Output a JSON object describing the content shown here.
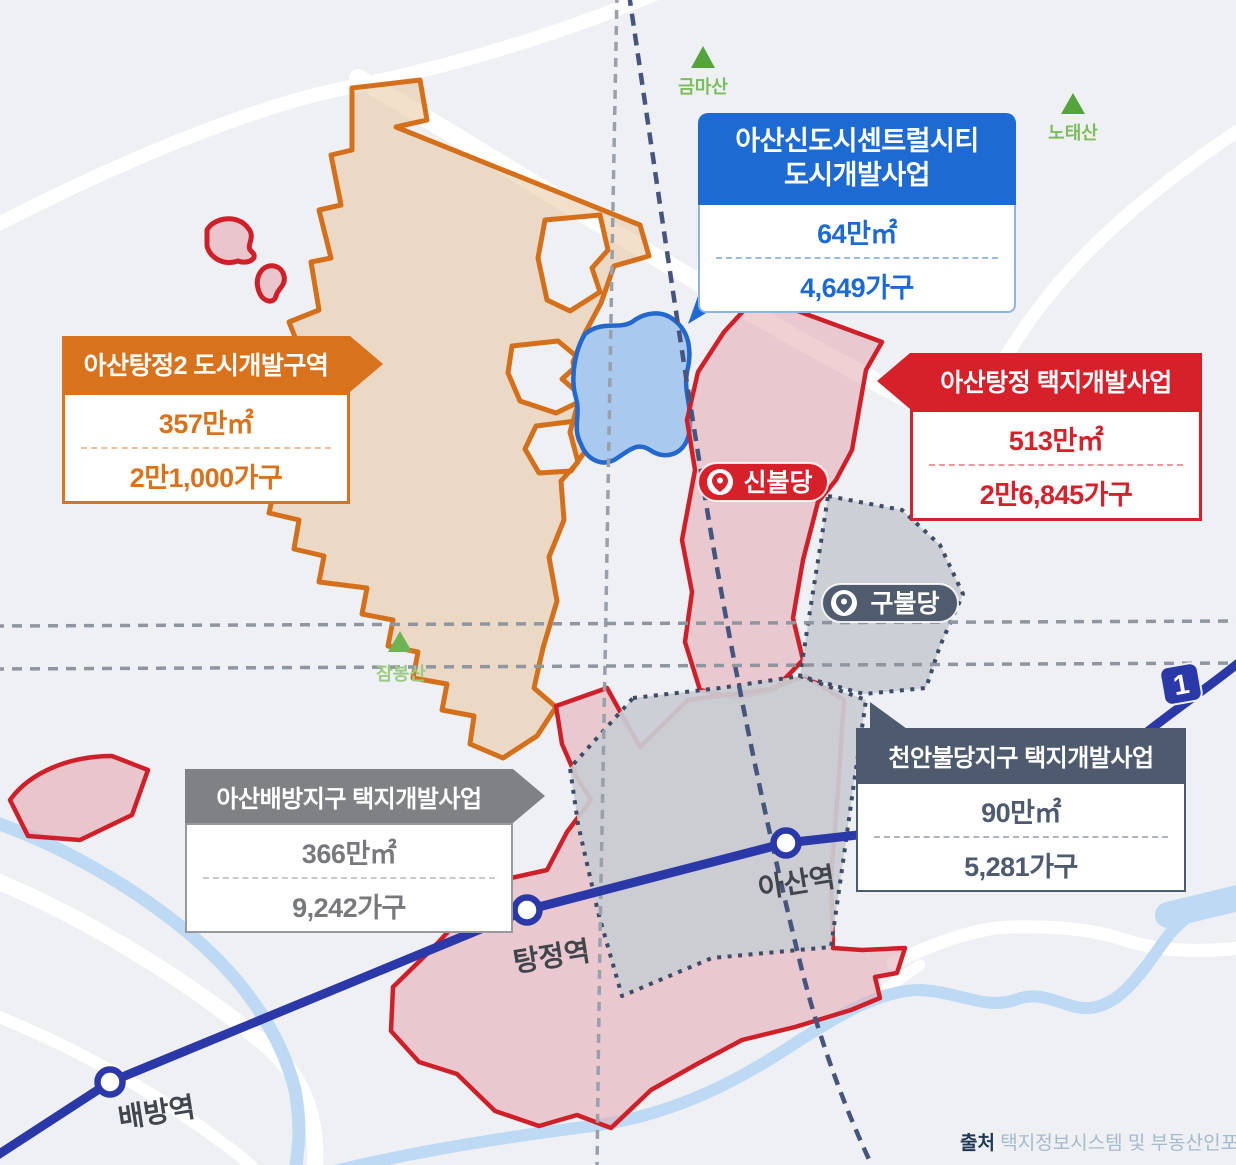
{
  "callouts": {
    "newtown": {
      "title_line1": "아산신도시센트럴시티",
      "title_line2": "도시개발사업",
      "area": "64만㎡",
      "households": "4,649가구",
      "color": "#1d6ad2"
    },
    "tangjeong2": {
      "title": "아산탕정2 도시개발구역",
      "area": "357만㎡",
      "households": "2만1,000가구",
      "color": "#d8721c"
    },
    "tangjeong": {
      "title": "아산탕정 택지개발사업",
      "area": "513만㎡",
      "households": "2만6,845가구",
      "color": "#d6202a"
    },
    "baebang": {
      "title": "아산배방지구 택지개발사업",
      "area": "366만㎡",
      "households": "9,242가구",
      "color": "#7f8184"
    },
    "cheonan_buldang": {
      "title": "천안불당지구 택지개발사업",
      "area": "90만㎡",
      "households": "5,281가구",
      "color": "#4e5a6e"
    }
  },
  "stations": {
    "baebang": "배방역",
    "tangjeong": "탕정역",
    "asan": "아산역"
  },
  "mountains": {
    "geumma": "금마산",
    "notae": "노태산",
    "jambong": "잠봉산"
  },
  "places": {
    "sinbuldang": "신불당",
    "gubuldang": "구불당"
  },
  "rail_line_badge": "1",
  "source": {
    "label": "출처",
    "text": "택지정보시스템 및 부동산인포"
  },
  "colors": {
    "background": "#eef0f4",
    "railway": "#2b38a8",
    "stream": "#bdd9f4",
    "zone_orange": "#d4701b",
    "zone_red": "#cf202a",
    "zone_blue": "#2268cd",
    "zone_gray_border": "#3f4c66",
    "mountain_green": "#55a43b"
  }
}
